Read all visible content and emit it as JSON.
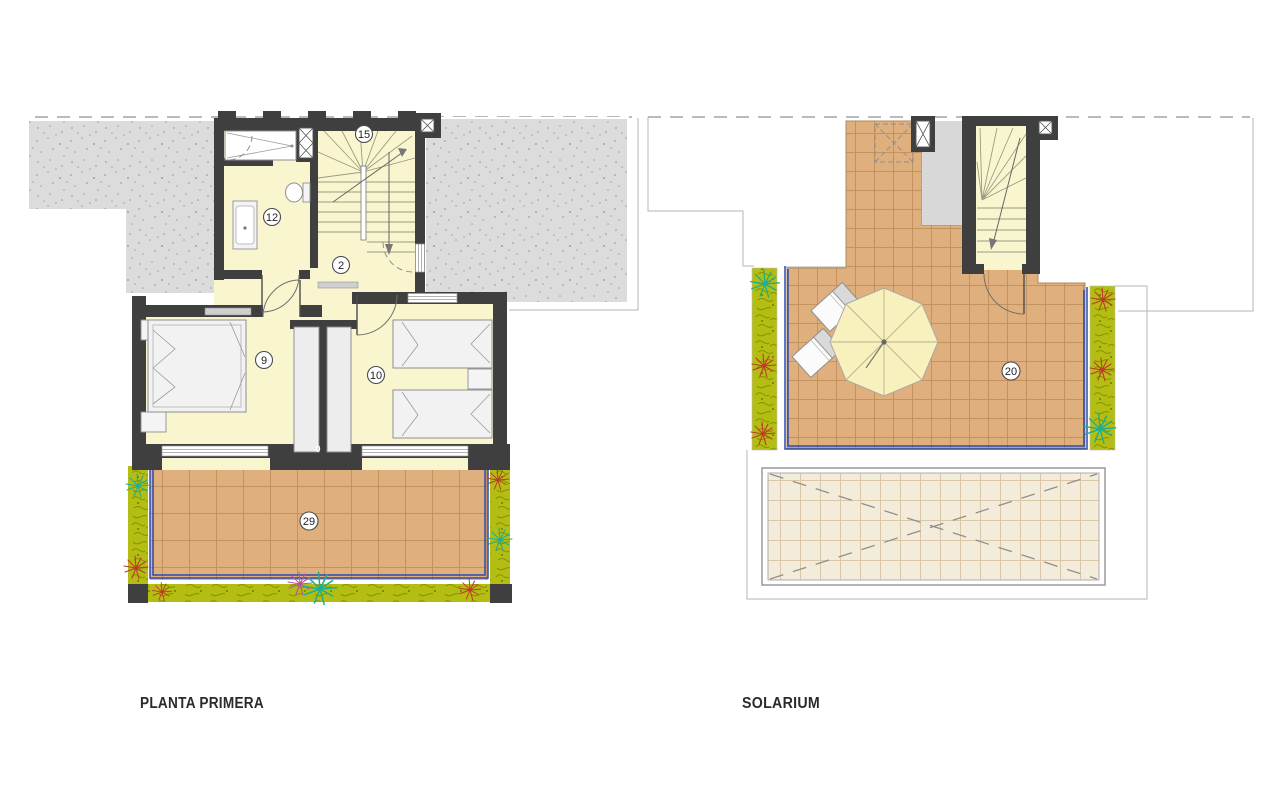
{
  "plans": [
    {
      "id": "planta-primera",
      "title": "PLANTA PRIMERA",
      "room_labels": [
        {
          "number": "15"
        },
        {
          "number": "12"
        },
        {
          "number": "2"
        },
        {
          "number": "9"
        },
        {
          "number": "10"
        },
        {
          "number": "29"
        },
        {
          "number": "0"
        }
      ]
    },
    {
      "id": "solarium",
      "title": "SOLARIUM",
      "room_labels": [
        {
          "number": "20"
        }
      ]
    }
  ],
  "icons": [
    "stairs-icon",
    "shower-icon",
    "toilet-icon",
    "sink-icon",
    "wardrobe-icon",
    "double-bed-icon",
    "single-bed-icon",
    "nightstand-icon",
    "umbrella-icon",
    "sun-lounger-icon",
    "plant-icon",
    "skylight-icon",
    "chimney-icon",
    "shaft-icon"
  ],
  "colors": {
    "wall": "#3f3f3f",
    "room": "#f9f6cf",
    "tile": "#dfaf7d",
    "tileLine": "#c2935f",
    "roofTile": "#f4ecda",
    "roofTileLine": "#d9c7a7",
    "green": "#b4be12",
    "greenDark": "#879104",
    "blue": "#2b4bad",
    "stipple": "#dcdcdc",
    "stippleDot": "#a2a2a2",
    "line": "#b5b5b5",
    "fixture": "#8f8f8f",
    "labelInk": "#222222",
    "titleInk": "#2b2b2b"
  }
}
